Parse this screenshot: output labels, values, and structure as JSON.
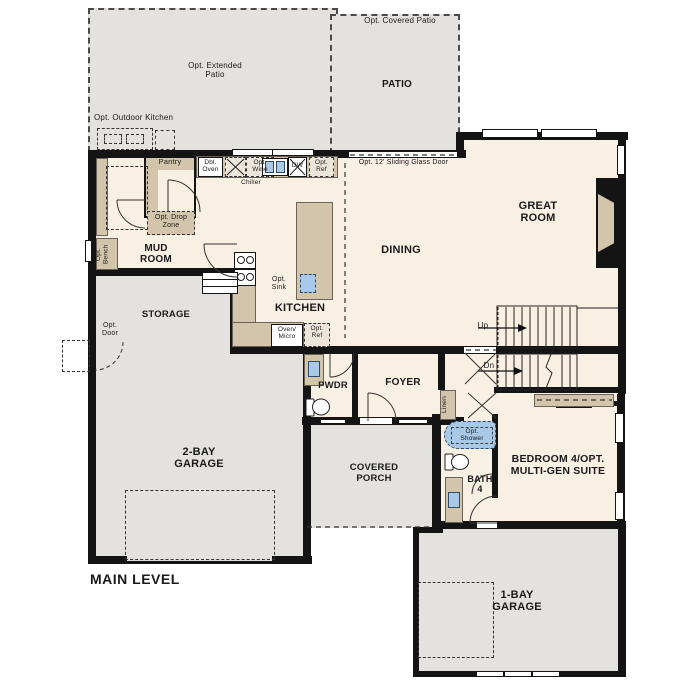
{
  "title": "MAIN LEVEL",
  "colors": {
    "wall": "#141414",
    "floor": "#f8f0e2",
    "patio": "#e3e2df",
    "cab": "#d2c5ab",
    "blue": "#a9c9e8",
    "ink": "#1a1a1a"
  },
  "labels": {
    "extended_patio": "Opt. Extended\nPatio",
    "outdoor_kitchen": "Opt. Outdoor Kitchen",
    "covered_patio": "Opt. Covered Patio",
    "patio": "PATIO",
    "pantry": "Pantry",
    "dbl_oven": "Dbl.\nOven",
    "wine": "Opt.\nWine",
    "chiller": "Chiller",
    "dw": "DW",
    "ref_top": "Opt.\nRef",
    "sliding_door": "Opt. 12' Sliding Glass Door",
    "great_room": "GREAT\nROOM",
    "drop_zone": "Opt. Drop\nZone",
    "mud_room": "MUD\nROOM",
    "bench": "Opt.\nBench",
    "dining": "DINING",
    "sink_opt": "Opt.\nSink",
    "kitchen": "KITCHEN",
    "storage": "STORAGE",
    "door_opt": "Opt.\nDoor",
    "oven_micro": "Oven/\nMicro",
    "ref_kitchen": "Opt.\nRef",
    "up": "Up",
    "dn": "Dn",
    "pwdr": "PWDR",
    "foyer": "FOYER",
    "linen": "Linen",
    "garage_2bay": "2-BAY\nGARAGE",
    "covered_porch": "COVERED\nPORCH",
    "shower_opt": "Opt.\nShower",
    "bath_4": "BATH\n4",
    "bedroom_4": "BEDROOM 4/OPT.\nMULTI-GEN SUITE",
    "garage_1bay": "1-BAY\nGARAGE",
    "main_level": "MAIN LEVEL"
  }
}
